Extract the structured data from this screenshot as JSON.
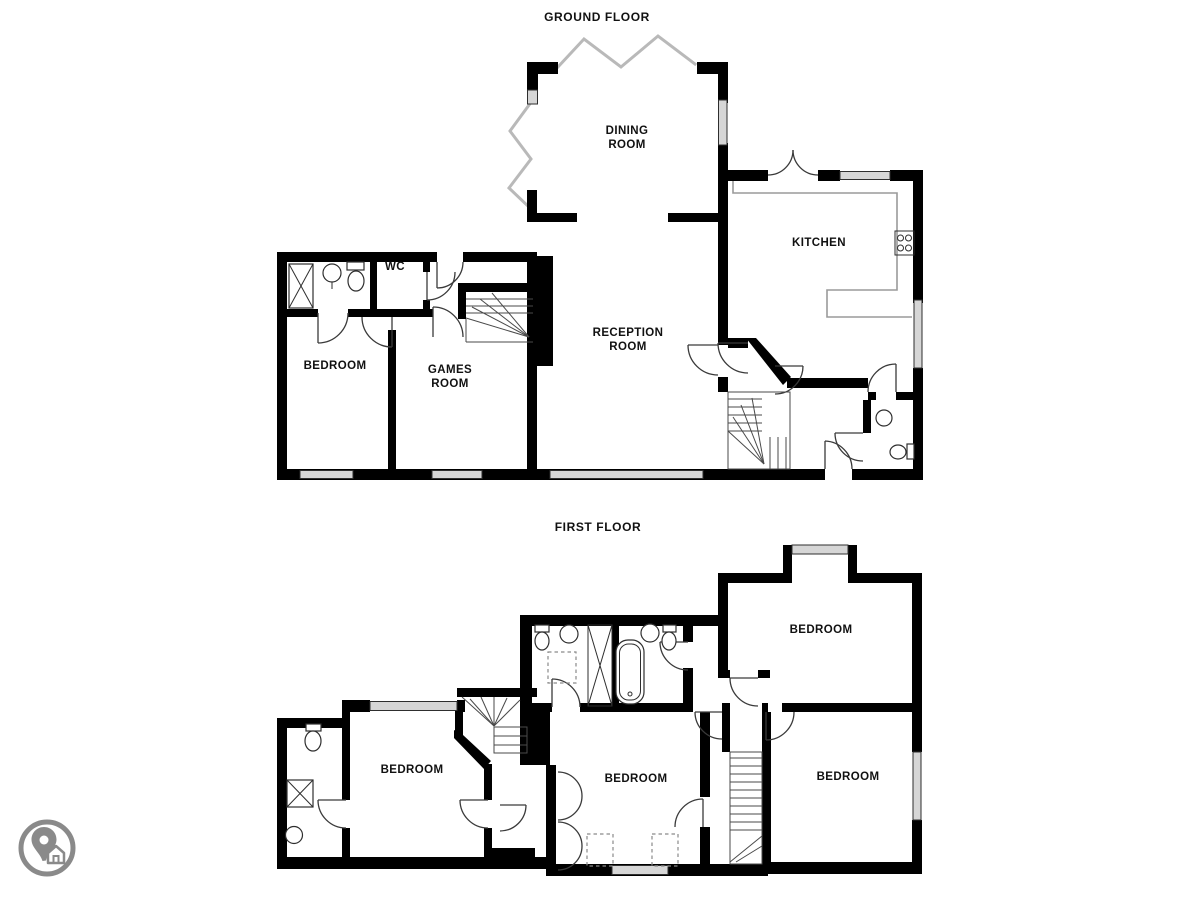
{
  "background": "#ffffff",
  "ground_floor": {
    "title": "GROUND FLOOR",
    "rooms": {
      "dining": "DINING\nROOM",
      "kitchen": "KITCHEN",
      "reception": "RECEPTION\nROOM",
      "bedroom": "BEDROOM",
      "games": "GAMES\nROOM",
      "wc": "WC"
    }
  },
  "first_floor": {
    "title": "FIRST FLOOR",
    "rooms": {
      "bedroom_top_right": "BEDROOM",
      "bedroom_left": "BEDROOM",
      "bedroom_middle": "BEDROOM",
      "bedroom_bottom_right": "BEDROOM"
    }
  },
  "logo": {
    "icon": "map-pin-home-logo",
    "color": "#8a8a8a"
  },
  "colors": {
    "wall": "#000000",
    "window_fill": "#d6d6d6",
    "window_stroke": "#2e2e2e",
    "glazing": "#b9b9b9",
    "counter": "#9a9a9a",
    "detail": "#3a3a3a"
  }
}
